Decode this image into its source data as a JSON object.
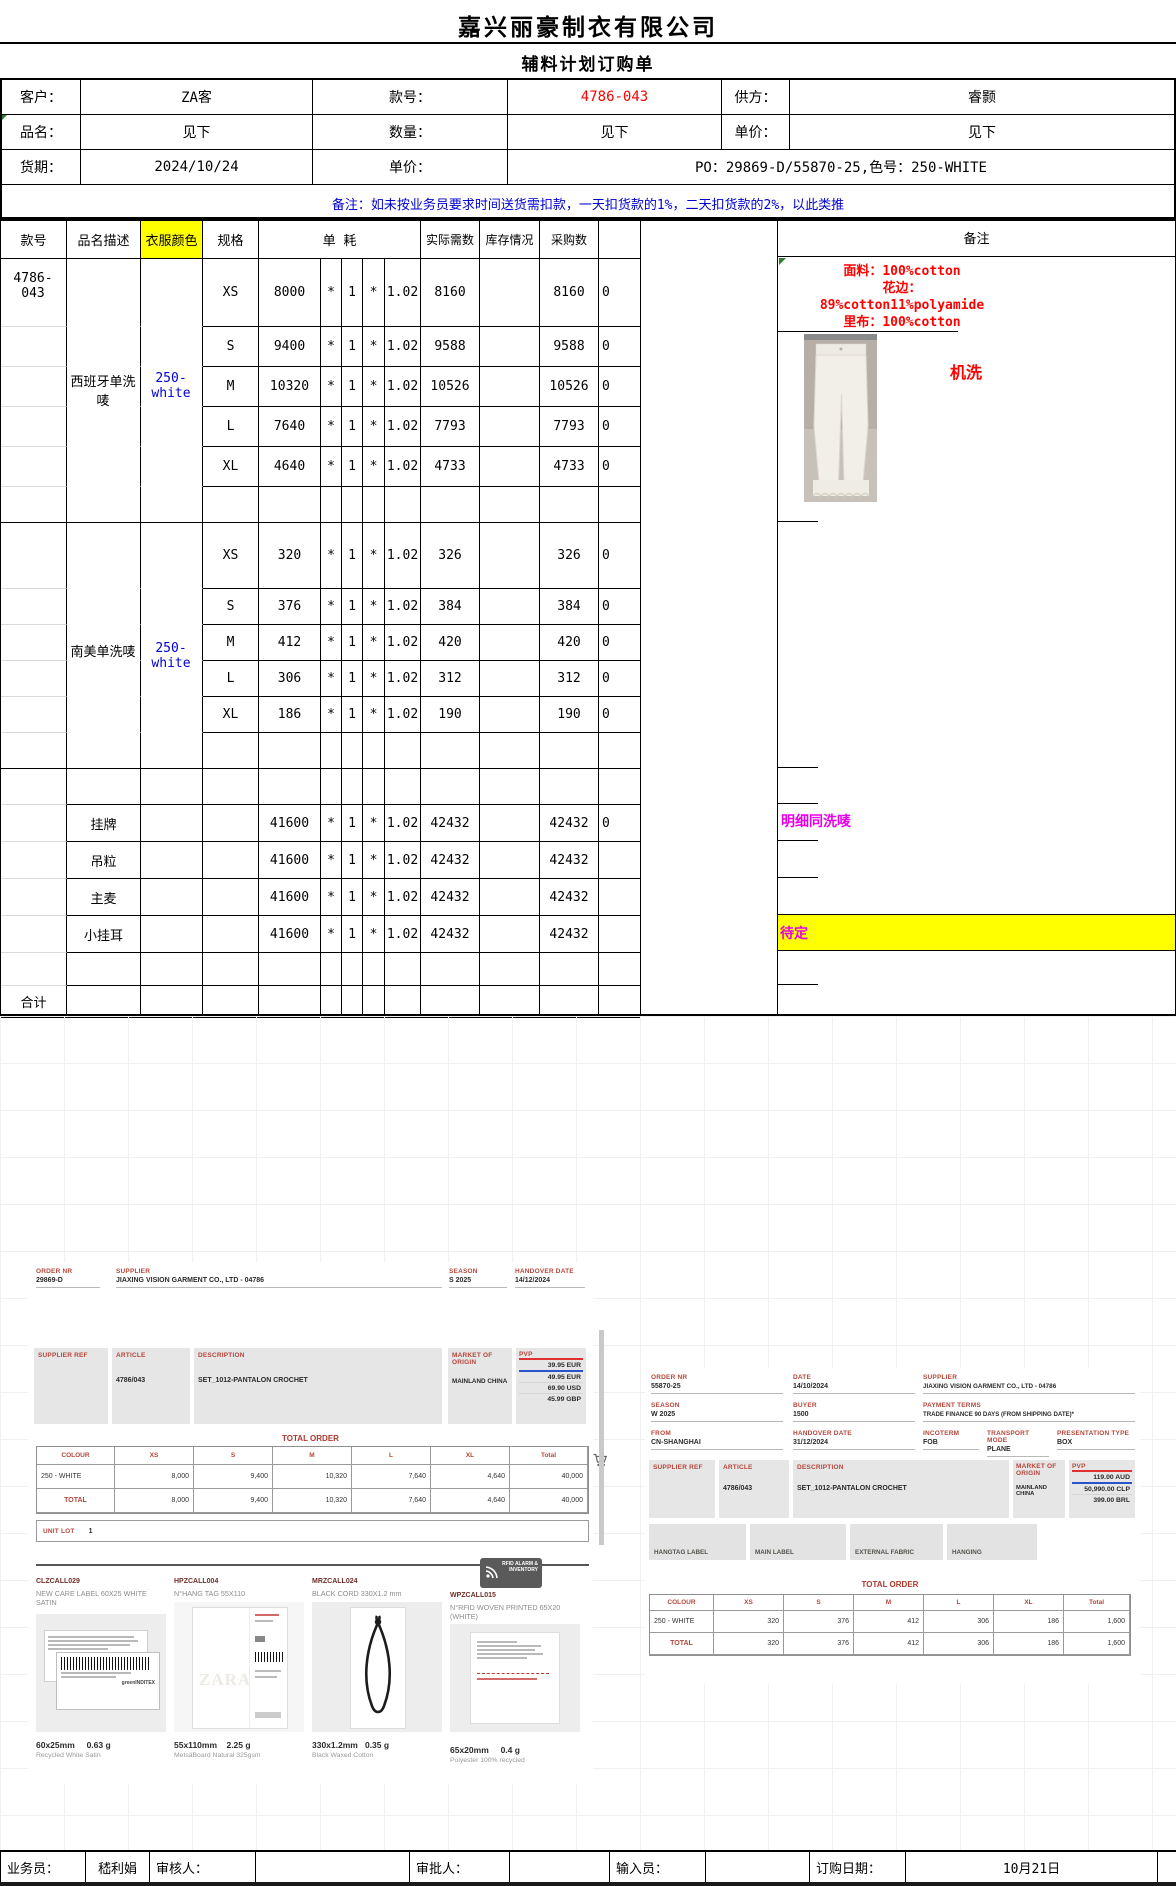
{
  "title": {
    "company": "嘉兴丽豪制衣有限公司",
    "form": "辅料计划订购单"
  },
  "info": {
    "customer_label": "客户：",
    "customer": "ZA客",
    "style_label": "款号：",
    "style_no": "4786-043",
    "supplier_label": "供方：",
    "supplier": "睿颢",
    "item_label": "品名：",
    "item": "见下",
    "qty_label": "数量：",
    "qty": "见下",
    "price_label": "单价：",
    "price": "见下",
    "delivery_label": "货期：",
    "delivery": "2024/10/24",
    "price2_label": "单价：",
    "po": "PO：29869-D/55870-25,色号：250-WHITE",
    "notice": "备注：如未按业务员要求时间送货需扣款，一天扣货款的1%，二天扣货款的2%，以此类推"
  },
  "table": {
    "headers": {
      "style": "款号",
      "desc": "品名描述",
      "color": "衣服颜色",
      "size": "规格",
      "usage": "单  耗",
      "actual": "实际需数",
      "stock": "库存情况",
      "purchase": "采购数",
      "blank": "",
      "remark": "备注"
    },
    "overlays": {
      "style_no": "4786-043",
      "b1_name": "西班牙单洗唛",
      "b1_color": "250-white",
      "b2_name": "南美单洗唛",
      "b2_color": "250-white"
    },
    "rows": [
      {
        "kind": "size",
        "h": 68,
        "m3": true,
        "c": [
          "",
          "",
          "",
          "XS",
          "8000",
          "*",
          "1",
          "*",
          "1.02",
          "8160",
          "",
          "8160",
          "0"
        ]
      },
      {
        "kind": "size",
        "h": 40,
        "m3": true,
        "c": [
          "",
          "",
          "",
          "S",
          "9400",
          "*",
          "1",
          "*",
          "1.02",
          "9588",
          "",
          "9588",
          "0"
        ]
      },
      {
        "kind": "size",
        "h": 40,
        "m3": true,
        "c": [
          "",
          "",
          "",
          "M",
          "10320",
          "*",
          "1",
          "*",
          "1.02",
          "10526",
          "",
          "10526",
          "0"
        ]
      },
      {
        "kind": "size",
        "h": 40,
        "m3": true,
        "c": [
          "",
          "",
          "",
          "L",
          "7640",
          "*",
          "1",
          "*",
          "1.02",
          "7793",
          "",
          "7793",
          "0"
        ]
      },
      {
        "kind": "size",
        "h": 40,
        "m3": true,
        "c": [
          "",
          "",
          "",
          "XL",
          "4640",
          "*",
          "1",
          "*",
          "1.02",
          "4733",
          "",
          "4733",
          "0"
        ]
      },
      {
        "kind": "filler",
        "h": 36,
        "m3": true,
        "end": true,
        "c": [
          "",
          "",
          "",
          "",
          "",
          "",
          "",
          "",
          "",
          "",
          "",
          "",
          ""
        ]
      },
      {
        "kind": "size",
        "h": 66,
        "m3": true,
        "c": [
          "",
          "",
          "",
          "XS",
          "320",
          "*",
          "1",
          "*",
          "1.02",
          "326",
          "",
          "326",
          "0"
        ]
      },
      {
        "kind": "size",
        "h": 36,
        "m3": true,
        "c": [
          "",
          "",
          "",
          "S",
          "376",
          "*",
          "1",
          "*",
          "1.02",
          "384",
          "",
          "384",
          "0"
        ]
      },
      {
        "kind": "size",
        "h": 36,
        "m3": true,
        "c": [
          "",
          "",
          "",
          "M",
          "412",
          "*",
          "1",
          "*",
          "1.02",
          "420",
          "",
          "420",
          "0"
        ]
      },
      {
        "kind": "size",
        "h": 36,
        "m3": true,
        "c": [
          "",
          "",
          "",
          "L",
          "306",
          "*",
          "1",
          "*",
          "1.02",
          "312",
          "",
          "312",
          "0"
        ]
      },
      {
        "kind": "size",
        "h": 36,
        "m3": true,
        "c": [
          "",
          "",
          "",
          "XL",
          "186",
          "*",
          "1",
          "*",
          "1.02",
          "190",
          "",
          "190",
          "0"
        ]
      },
      {
        "kind": "filler",
        "h": 36,
        "m3": true,
        "end": true,
        "c": [
          "",
          "",
          "",
          "",
          "",
          "",
          "",
          "",
          "",
          "",
          "",
          "",
          ""
        ]
      },
      {
        "kind": "filler",
        "h": 36,
        "m1": true,
        "c": [
          "",
          "",
          "",
          "",
          "",
          "",
          "",
          "",
          "",
          "",
          "",
          "",
          ""
        ]
      },
      {
        "kind": "acc",
        "h": 37,
        "m1": true,
        "c": [
          "",
          "挂牌",
          "",
          "",
          "41600",
          "*",
          "1",
          "*",
          "1.02",
          "42432",
          "",
          "42432",
          "0"
        ]
      },
      {
        "kind": "acc",
        "h": 37,
        "m1": true,
        "c": [
          "",
          "吊粒",
          "",
          "",
          "41600",
          "*",
          "1",
          "*",
          "1.02",
          "42432",
          "",
          "42432",
          ""
        ]
      },
      {
        "kind": "acc",
        "h": 37,
        "m1": true,
        "c": [
          "",
          "主麦",
          "",
          "",
          "41600",
          "*",
          "1",
          "*",
          "1.02",
          "42432",
          "",
          "42432",
          ""
        ]
      },
      {
        "kind": "acc",
        "h": 37,
        "m1": true,
        "c": [
          "",
          "小挂耳",
          "",
          "",
          "41600",
          "*",
          "1",
          "*",
          "1.02",
          "42432",
          "",
          "42432",
          ""
        ]
      },
      {
        "kind": "filler",
        "h": 33,
        "m1": true,
        "c": [
          "",
          "",
          "",
          "",
          "",
          "",
          "",
          "",
          "",
          "",
          "",
          "",
          ""
        ]
      },
      {
        "kind": "total",
        "h": 32,
        "c": [
          "合计",
          "",
          "",
          "",
          "",
          "",
          "",
          "",
          "",
          "",
          "",
          "",
          ""
        ]
      }
    ]
  },
  "remarks": {
    "fabric": "面料：100%cotton",
    "lace_label": "花边：",
    "lace": "89%cotton11%polyamide",
    "lining": "里布：100%cotton",
    "wash": "机洗",
    "hangtag": "明细同洗唛",
    "pending": "待定"
  },
  "doc_left": {
    "order_nr_label": "ORDER NR",
    "order_nr": "29869-D",
    "supplier_label": "SUPPLIER",
    "supplier": "JIAXING VISION GARMENT CO., LTD - 04786",
    "season_label": "SEASON",
    "season": "S 2025",
    "handover_label": "HANDOVER DATE",
    "handover": "14/12/2024",
    "supplier_ref_label": "SUPPLIER REF",
    "article_label": "ARTICLE",
    "article": "4786/043",
    "description_label": "DESCRIPTION",
    "description": "SET_1012-PANTALON CROCHET",
    "market_label": "MARKET OF ORIGIN",
    "market": "MAINLAND CHINA",
    "pvp_label": "PVP",
    "pvp": [
      "39.95 EUR",
      "49.95 EUR",
      "69.90 USD",
      "45.99 GBP"
    ],
    "total_order_label": "TOTAL ORDER",
    "table": {
      "cols": [
        "COLOUR",
        "XS",
        "S",
        "M",
        "L",
        "XL",
        "Total"
      ],
      "rows": [
        [
          "250 - WHITE",
          "8,000",
          "9,400",
          "10,320",
          "7,640",
          "4,640",
          "40,000"
        ],
        [
          "TOTAL",
          "8,000",
          "9,400",
          "10,320",
          "7,640",
          "4,640",
          "40,000"
        ]
      ]
    },
    "unit_lot_label": "UNIT LOT",
    "unit_lot": "1"
  },
  "doc_right": {
    "order_nr_label": "ORDER NR",
    "order_nr": "55870-25",
    "date_label": "DATE",
    "date": "14/10/2024",
    "supplier_label": "SUPPLIER",
    "supplier": "JIAXING VISION GARMENT CO., LTD - 04786",
    "season_label": "SEASON",
    "season": "W 2025",
    "buyer_label": "BUYER",
    "buyer": "1500",
    "payment_label": "PAYMENT TERMS",
    "payment": "TRADE FINANCE 90 DAYS (FROM SHIPPING DATE)*",
    "from_label": "FROM",
    "from": "CN-SHANGHAI",
    "handover_label": "HANDOVER DATE",
    "handover": "31/12/2024",
    "incoterm_label": "INCOTERM",
    "incoterm": "FOB",
    "transport_label": "TRANSPORT MODE",
    "transport": "PLANE",
    "presentation_label": "PRESENTATION TYPE",
    "presentation": "BOX",
    "supplier_ref_label": "SUPPLIER REF",
    "article_label": "ARTICLE",
    "article": "4786/043",
    "description_label": "DESCRIPTION",
    "description": "SET_1012-PANTALON CROCHET",
    "market_label": "MARKET OF ORIGIN",
    "market": "MAINLAND CHINA",
    "pvp_label": "PVP",
    "pvp": [
      "119.00 AUD",
      "50,990.00 CLP",
      "399.00 BRL"
    ],
    "buttons": [
      "HANGTAG LABEL",
      "MAIN LABEL",
      "EXTERNAL FABRIC",
      "HANGING"
    ],
    "total_order_label": "TOTAL ORDER",
    "table": {
      "cols": [
        "COLOUR",
        "XS",
        "S",
        "M",
        "L",
        "XL",
        "Total"
      ],
      "rows": [
        [
          "250 - WHITE",
          "320",
          "376",
          "412",
          "306",
          "186",
          "1,600"
        ],
        [
          "TOTAL",
          "320",
          "376",
          "412",
          "306",
          "186",
          "1,600"
        ]
      ]
    }
  },
  "items": [
    {
      "code": "CLZCALL029",
      "desc": "NEW CARE LABEL 60X25 WHITE SATIN",
      "size": "60x25mm",
      "weight": "0.63 g",
      "material": "Recycled White Satin"
    },
    {
      "code": "HPZCALL004",
      "desc": "N°HANG TAG 55X110",
      "size": "55x110mm",
      "weight": "2.25 g",
      "material": "MetsäBoard Natural 325gsm"
    },
    {
      "code": "MRZCALL024",
      "desc": "BLACK CORD 330X1.2 mm",
      "size": "330x1.2mm",
      "weight": "0.35 g",
      "material": "Black Waxed Cotton"
    },
    {
      "code": "WPZCALL015",
      "desc": "N°RFID WOVEN PRINTED 65X20 (WHITE)",
      "size": "65x20mm",
      "weight": "0.4 g",
      "material": "Polyester 100% recycled"
    }
  ],
  "rfid_badge": {
    "line1": "RFID ALARM &",
    "line2": "INVENTORY"
  },
  "zara_watermark": "ZARA",
  "inditex_text": "greenINDITEX",
  "footer": {
    "sales_label": "业务员：",
    "sales": "嵇利娟",
    "check_label": "审核人：",
    "approve_label": "审批人：",
    "input_label": "输入员：",
    "date_label": "订购日期：",
    "date": "10月21日"
  }
}
